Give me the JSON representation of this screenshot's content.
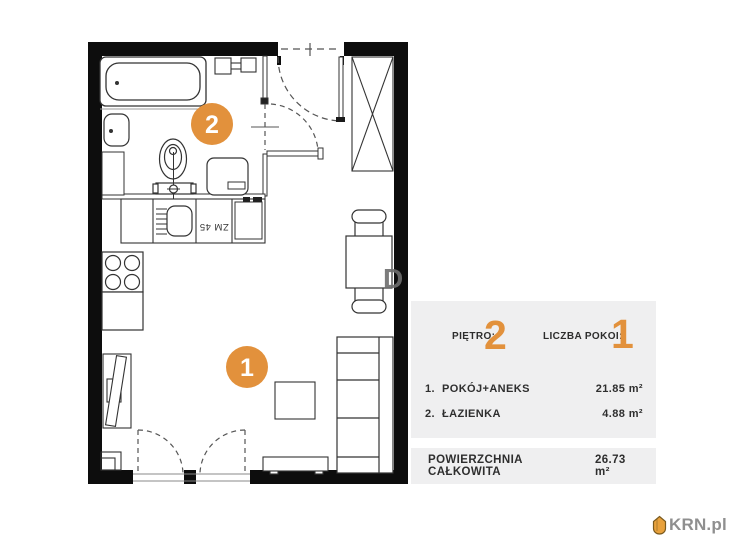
{
  "plan": {
    "room_badges": [
      {
        "number": "1"
      },
      {
        "number": "2"
      }
    ],
    "dishwasher_label": "ZM 45",
    "watermark_letter": "D"
  },
  "panel": {
    "floor_label": "PIĘTRO:",
    "floor_value": "2",
    "rooms_label": "LICZBA POKOI:",
    "rooms_value": "1",
    "rooms": [
      {
        "index": "1.",
        "name": "POKÓJ+ANEKS",
        "area": "21.85 m²"
      },
      {
        "index": "2.",
        "name": "ŁAZIENKA",
        "area": "4.88 m²"
      }
    ],
    "total_label": "POWIERZCHNIA CAŁKOWITA",
    "total_value": "26.73 m²"
  },
  "logo": {
    "text": "KRN.pl"
  },
  "colors": {
    "accent": "#E2913C",
    "panel_bg": "#EFEFF0",
    "wall": "#0D0D0D"
  }
}
